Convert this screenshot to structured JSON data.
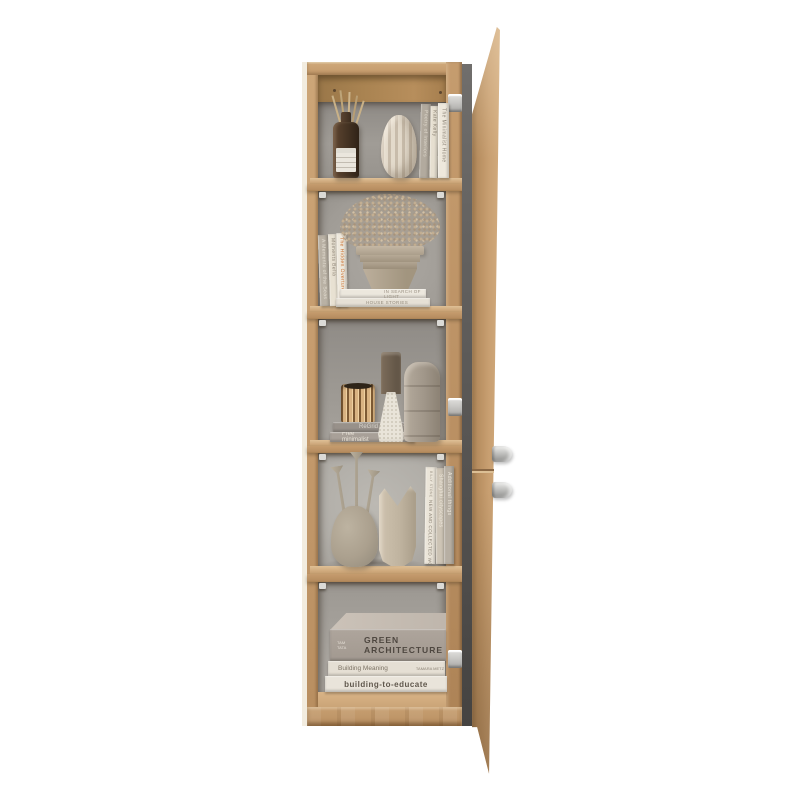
{
  "product": {
    "name": "Tall five-shelf bookcase with open right-hand door, styled with decor",
    "colors": {
      "wood": "#c49c6e",
      "wood_dark": "#a8824f",
      "back_panel": "#a29e98",
      "door_inner": "#5c5a58",
      "knob": "#c9c9c7",
      "background": "#ffffff"
    }
  },
  "compartment1": {
    "items": [
      "reed-diffuser-bottle",
      "ribbed-ceramic-vase"
    ],
    "books": [
      {
        "spine": "Poetry of Interiors"
      },
      {
        "spine": "Kate Kelly"
      },
      {
        "spine": "The Minimalist Home"
      }
    ]
  },
  "compartment2": {
    "items": [
      "dried-flower-bouquet",
      "stepped-planter-pot"
    ],
    "books_vertical": [
      {
        "spine": "A Memento of the Seas"
      },
      {
        "spine": "Moments Bella"
      },
      {
        "spine": "The Hidden Overture"
      }
    ],
    "books_stack": [
      {
        "spine": "IN SEARCH OF LIGHT"
      },
      {
        "spine": "HOUSE STORIES"
      }
    ]
  },
  "compartment3": {
    "items": [
      "ribbed-gold-vase",
      "speckled-candle-holder",
      "taupe-candle",
      "tall-stone-vase"
    ],
    "books_stack": [
      {
        "spine": "ReGrid",
        "author": "Timothy C. Wilson"
      },
      {
        "spine": "Free minimalist",
        "author": "Anya Gregory"
      }
    ]
  },
  "compartment4": {
    "items": [
      "triple-neck-sculptural-vase",
      "crescent-top-vase"
    ],
    "books": [
      {
        "spine": "NEW AND COLLECTED WORKS",
        "author": "BILLY STONE"
      },
      {
        "spine": "Shanghai cityscapes",
        "author": "Diane Weber"
      },
      {
        "spine": "Additional things",
        "author": "Simon Clark"
      }
    ]
  },
  "compartment5": {
    "books_stack": [
      {
        "spine": "GREEN ARCHITECTURE",
        "author": "TAM TATA"
      },
      {
        "spine": "Building Meaning",
        "author": "TAMARA METZ"
      },
      {
        "spine": "building-to-educate"
      }
    ]
  }
}
